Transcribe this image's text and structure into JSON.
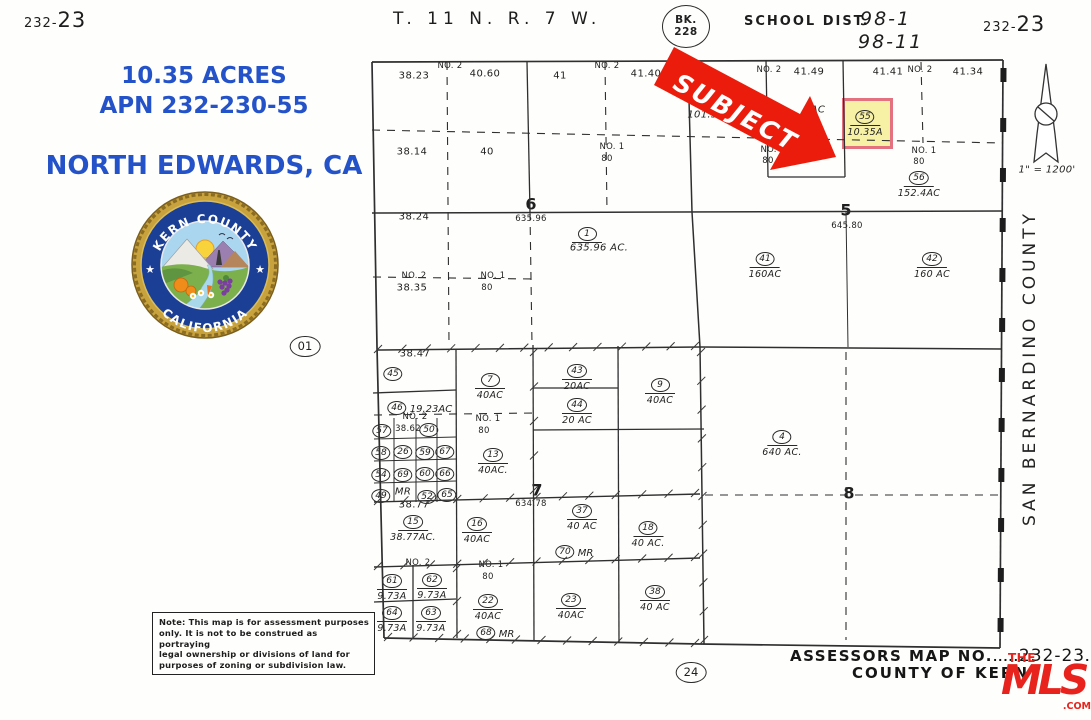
{
  "colors": {
    "ink": "#2f2f2f",
    "blue": "#2452c8",
    "red": "#ec1c0c",
    "mls_red": "#e8231d",
    "highlight_fill": "#f7f1a6",
    "highlight_border": "#e4717f"
  },
  "header": {
    "sheet_left_small": "232-",
    "sheet_left_big": "23",
    "township": "T. 11 N.  R. 7 W.",
    "bk_line1": "BK.",
    "bk_line2": "228",
    "school_label": "SCHOOL  DIST.",
    "school_1": "98-1",
    "school_2": "98-11",
    "sheet_right_small": "232-",
    "sheet_right_big": "23"
  },
  "info": {
    "acres": "10.35 ACRES",
    "apn": "APN 232-230-55",
    "city": "NORTH EDWARDS, CA"
  },
  "seal": {
    "top_text": "KERN COUNTY",
    "bottom_text": "CALIFORNIA",
    "star": "★"
  },
  "subject": {
    "label": "SUBJECT"
  },
  "scale_label": "1\" = 1200'",
  "county_vertical": "SAN  BERNARDINO  COUNTY",
  "footer": {
    "note_lines": [
      "Note: This map is for assessment purposes",
      "only. It is not to be construed as portraying",
      "legal ownership or divisions of land for",
      "purposes of zoning or subdivision law."
    ],
    "circle24": "24",
    "assessors_label": "ASSESSORS  MAP  NO.",
    "dots_left": ".....",
    "map_no": "232-23",
    "dots_right": ".....",
    "county_line": "COUNTY  OF  KERN"
  },
  "mls": {
    "the": "THE",
    "name": "MLS",
    "tm": "™",
    "com": ".COM"
  },
  "map_labels": [
    {
      "x": 414,
      "y": 76,
      "t": "38.23",
      "c": "v"
    },
    {
      "x": 485,
      "y": 74,
      "t": "40.60",
      "c": "v"
    },
    {
      "x": 560,
      "y": 76,
      "t": "41",
      "c": "v"
    },
    {
      "x": 646,
      "y": 74,
      "t": "41.40",
      "c": "v"
    },
    {
      "x": 809,
      "y": 72,
      "t": "41.49",
      "c": "v"
    },
    {
      "x": 888,
      "y": 72,
      "t": "41.41",
      "c": "v"
    },
    {
      "x": 968,
      "y": 72,
      "t": "41.34",
      "c": "v"
    },
    {
      "x": 450,
      "y": 66,
      "t": "NO.  2",
      "c": "s"
    },
    {
      "x": 607,
      "y": 66,
      "t": "NO.  2",
      "c": "s"
    },
    {
      "x": 769,
      "y": 70,
      "t": "NO.  2",
      "c": "s"
    },
    {
      "x": 920,
      "y": 70,
      "t": "NO.  2",
      "c": "s"
    },
    {
      "x": 412,
      "y": 152,
      "t": "38.14",
      "c": "v"
    },
    {
      "x": 487,
      "y": 152,
      "t": "40",
      "c": "v"
    },
    {
      "x": 612,
      "y": 147,
      "t": "NO.  1",
      "c": "s"
    },
    {
      "x": 607,
      "y": 159,
      "t": "80",
      "c": "s"
    },
    {
      "x": 773,
      "y": 150,
      "t": "NO.  1",
      "c": "s"
    },
    {
      "x": 768,
      "y": 161,
      "t": "80",
      "c": "s"
    },
    {
      "x": 924,
      "y": 151,
      "t": "NO.  1",
      "c": "s"
    },
    {
      "x": 919,
      "y": 162,
      "t": "80",
      "c": "s"
    },
    {
      "x": 713,
      "y": 115,
      "t": "101.56AC",
      "c": "i"
    },
    {
      "x": 818,
      "y": 110,
      "t": "AC",
      "c": "i"
    },
    {
      "x": 531,
      "y": 204,
      "t": "6",
      "c": "b"
    },
    {
      "x": 531,
      "y": 219,
      "t": "635.96",
      "c": "s"
    },
    {
      "x": 414,
      "y": 217,
      "t": "38.24",
      "c": "v"
    },
    {
      "x": 599,
      "y": 248,
      "t": "635.96 AC.",
      "c": "i"
    },
    {
      "x": 414,
      "y": 276,
      "t": "NO.  2",
      "c": "s"
    },
    {
      "x": 412,
      "y": 288,
      "t": "38.35",
      "c": "v"
    },
    {
      "x": 493,
      "y": 276,
      "t": "NO.  1",
      "c": "s"
    },
    {
      "x": 487,
      "y": 288,
      "t": "80",
      "c": "s"
    },
    {
      "x": 846,
      "y": 210,
      "t": "5",
      "c": "b"
    },
    {
      "x": 847,
      "y": 226,
      "t": "645.80",
      "c": "s"
    },
    {
      "x": 415,
      "y": 354,
      "t": "38.47",
      "c": "v"
    },
    {
      "x": 415,
      "y": 417,
      "t": "NO.  2",
      "c": "s"
    },
    {
      "x": 408,
      "y": 429,
      "t": "38.62",
      "c": "s"
    },
    {
      "x": 488,
      "y": 419,
      "t": "NO.  1",
      "c": "s"
    },
    {
      "x": 484,
      "y": 431,
      "t": "80",
      "c": "s"
    },
    {
      "x": 403,
      "y": 492,
      "t": "MR",
      "c": "i"
    },
    {
      "x": 414,
      "y": 505,
      "t": "38.77",
      "c": "v"
    },
    {
      "x": 537,
      "y": 490,
      "t": "7",
      "c": "b"
    },
    {
      "x": 531,
      "y": 504,
      "t": "634.78",
      "c": "s"
    },
    {
      "x": 418,
      "y": 563,
      "t": "NO.  2",
      "c": "s"
    },
    {
      "x": 491,
      "y": 565,
      "t": "NO.  1",
      "c": "s"
    },
    {
      "x": 488,
      "y": 577,
      "t": "80",
      "c": "s"
    },
    {
      "x": 849,
      "y": 493,
      "t": "8",
      "c": "b"
    },
    {
      "x": 1047,
      "y": 170,
      "t": "1\" = 1200'",
      "c": "i"
    }
  ],
  "parcels": [
    {
      "num": "45",
      "x": 393,
      "y": 370
    },
    {
      "num": "7",
      "x": 490,
      "y": 376,
      "area": "40AC"
    },
    {
      "num": "43",
      "x": 577,
      "y": 367,
      "area": "20AC"
    },
    {
      "num": "9",
      "x": 660,
      "y": 381,
      "area": "40AC"
    },
    {
      "num": "46",
      "x": 397,
      "y": 404,
      "side": "19.23AC"
    },
    {
      "num": "44",
      "x": 577,
      "y": 401,
      "area": "20 AC"
    },
    {
      "num": "57",
      "x": 382,
      "y": 427
    },
    {
      "num": "50",
      "x": 429,
      "y": 426
    },
    {
      "num": "58",
      "x": 381,
      "y": 449
    },
    {
      "num": "26",
      "x": 403,
      "y": 448
    },
    {
      "num": "59",
      "x": 425,
      "y": 449
    },
    {
      "num": "67",
      "x": 445,
      "y": 448
    },
    {
      "num": "54",
      "x": 381,
      "y": 471
    },
    {
      "num": "69",
      "x": 403,
      "y": 471
    },
    {
      "num": "60",
      "x": 425,
      "y": 470
    },
    {
      "num": "66",
      "x": 445,
      "y": 470
    },
    {
      "num": "49",
      "x": 381,
      "y": 492
    },
    {
      "num": "52",
      "x": 427,
      "y": 493
    },
    {
      "num": "65",
      "x": 447,
      "y": 491
    },
    {
      "num": "13",
      "x": 493,
      "y": 451,
      "area": "40AC."
    },
    {
      "num": "15",
      "x": 413,
      "y": 518,
      "area": "38.77AC."
    },
    {
      "num": "16",
      "x": 477,
      "y": 520,
      "area": "40AC"
    },
    {
      "num": "37",
      "x": 582,
      "y": 507,
      "area": "40 AC"
    },
    {
      "num": "70",
      "x": 565,
      "y": 548,
      "side": "MR"
    },
    {
      "num": "18",
      "x": 648,
      "y": 524,
      "area": "40 AC."
    },
    {
      "num": "61",
      "x": 392,
      "y": 577,
      "area": "9.73A"
    },
    {
      "num": "62",
      "x": 432,
      "y": 576,
      "area": "9.73A"
    },
    {
      "num": "64",
      "x": 392,
      "y": 609,
      "area": "9.73A"
    },
    {
      "num": "63",
      "x": 431,
      "y": 609,
      "area": "9.73A"
    },
    {
      "num": "22",
      "x": 488,
      "y": 597,
      "area": "40AC"
    },
    {
      "num": "68",
      "x": 486,
      "y": 629,
      "side": "MR"
    },
    {
      "num": "23",
      "x": 571,
      "y": 596,
      "area": "40AC"
    },
    {
      "num": "38",
      "x": 655,
      "y": 588,
      "area": "40 AC"
    },
    {
      "num": "4",
      "x": 782,
      "y": 433,
      "area": "640 AC."
    },
    {
      "num": "41",
      "x": 765,
      "y": 255,
      "area": "160AC"
    },
    {
      "num": "42",
      "x": 932,
      "y": 255,
      "area": "160 AC"
    },
    {
      "num": "1",
      "x": 587,
      "y": 230,
      "bar": true
    },
    {
      "num": "56",
      "x": 919,
      "y": 174,
      "area": "152.4AC"
    },
    {
      "num": "55",
      "x": 865,
      "y": 113,
      "area": "10.35A"
    },
    {
      "num": "01",
      "x": 305,
      "y": 344,
      "wide": true
    },
    {
      "num": "24",
      "x": 691,
      "y": 670,
      "wide": true
    }
  ]
}
